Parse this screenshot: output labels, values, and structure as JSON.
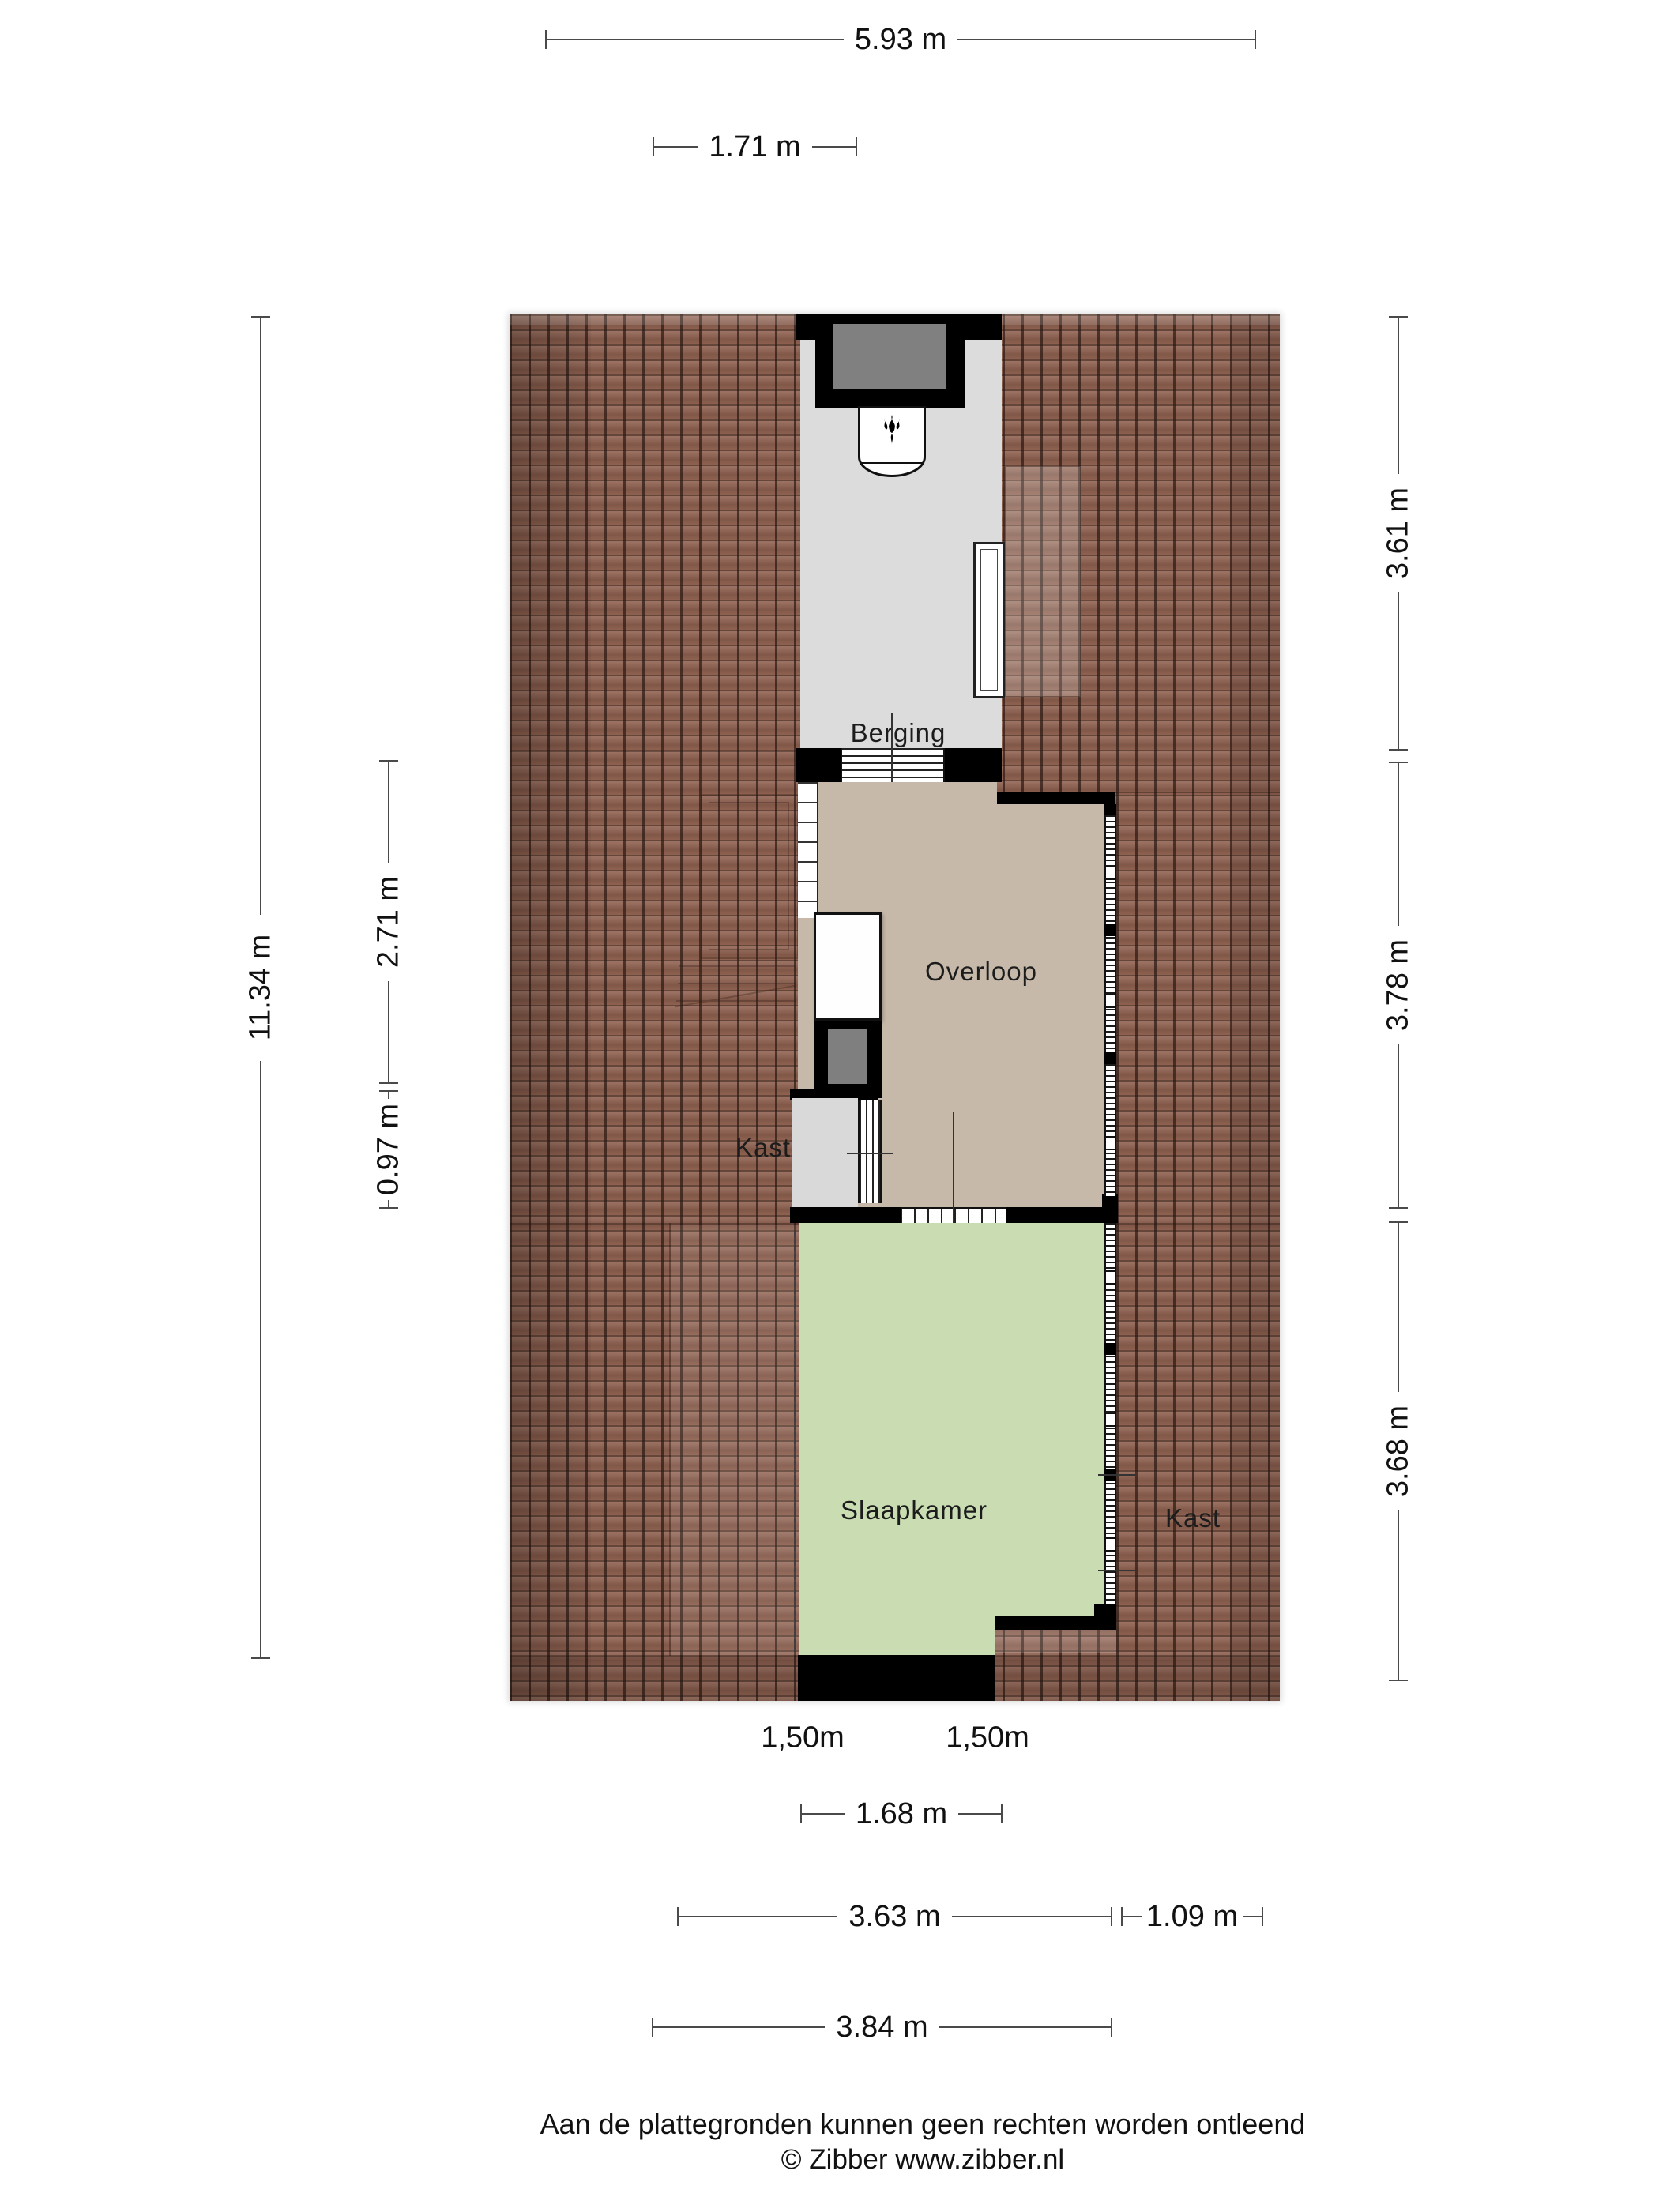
{
  "title": "Zibber plattegrond - verdieping met Berging, Overloop en Slaapkamer",
  "rooms": {
    "berging": "Berging",
    "overloop": "Overloop",
    "kast_left": "Kast",
    "slaapkamer": "Slaapkamer",
    "kast_right": "Kast"
  },
  "dims": {
    "w_total": "5.93 m",
    "w_berging": "1.71 m",
    "h_total": "11.34 m",
    "h_overloop": "2.71 m",
    "h_kast": "0.97 m",
    "h_berging_r": "3.61 m",
    "h_overloop_r": "3.78 m",
    "h_slaapkamer_r": "3.68 m",
    "headroom_left": "1,50m",
    "headroom_right": "1,50m",
    "w_door": "1.68 m",
    "w_slaapkamer": "3.63 m",
    "w_kast_r": "1.09 m",
    "w_slaapkamer_total": "3.84 m"
  },
  "footer": {
    "disclaimer": "Aan de plattegronden kunnen geen rechten worden ontleend",
    "copyright": "© Zibber www.zibber.nl"
  },
  "icons": {
    "boiler_flame": "flame-icon"
  },
  "colors": {
    "roof_base": "#8f6150",
    "wall": "#000000",
    "berging_floor": "#dcdcdd",
    "overloop_floor": "#c7b9a9",
    "slaapkamer_floor": "#c9dcb2",
    "kast_floor": "#d9d9d9",
    "chimney_gray": "#808080",
    "shaft_gray": "#7f7f7f",
    "dim_line": "#4a4a4a"
  }
}
